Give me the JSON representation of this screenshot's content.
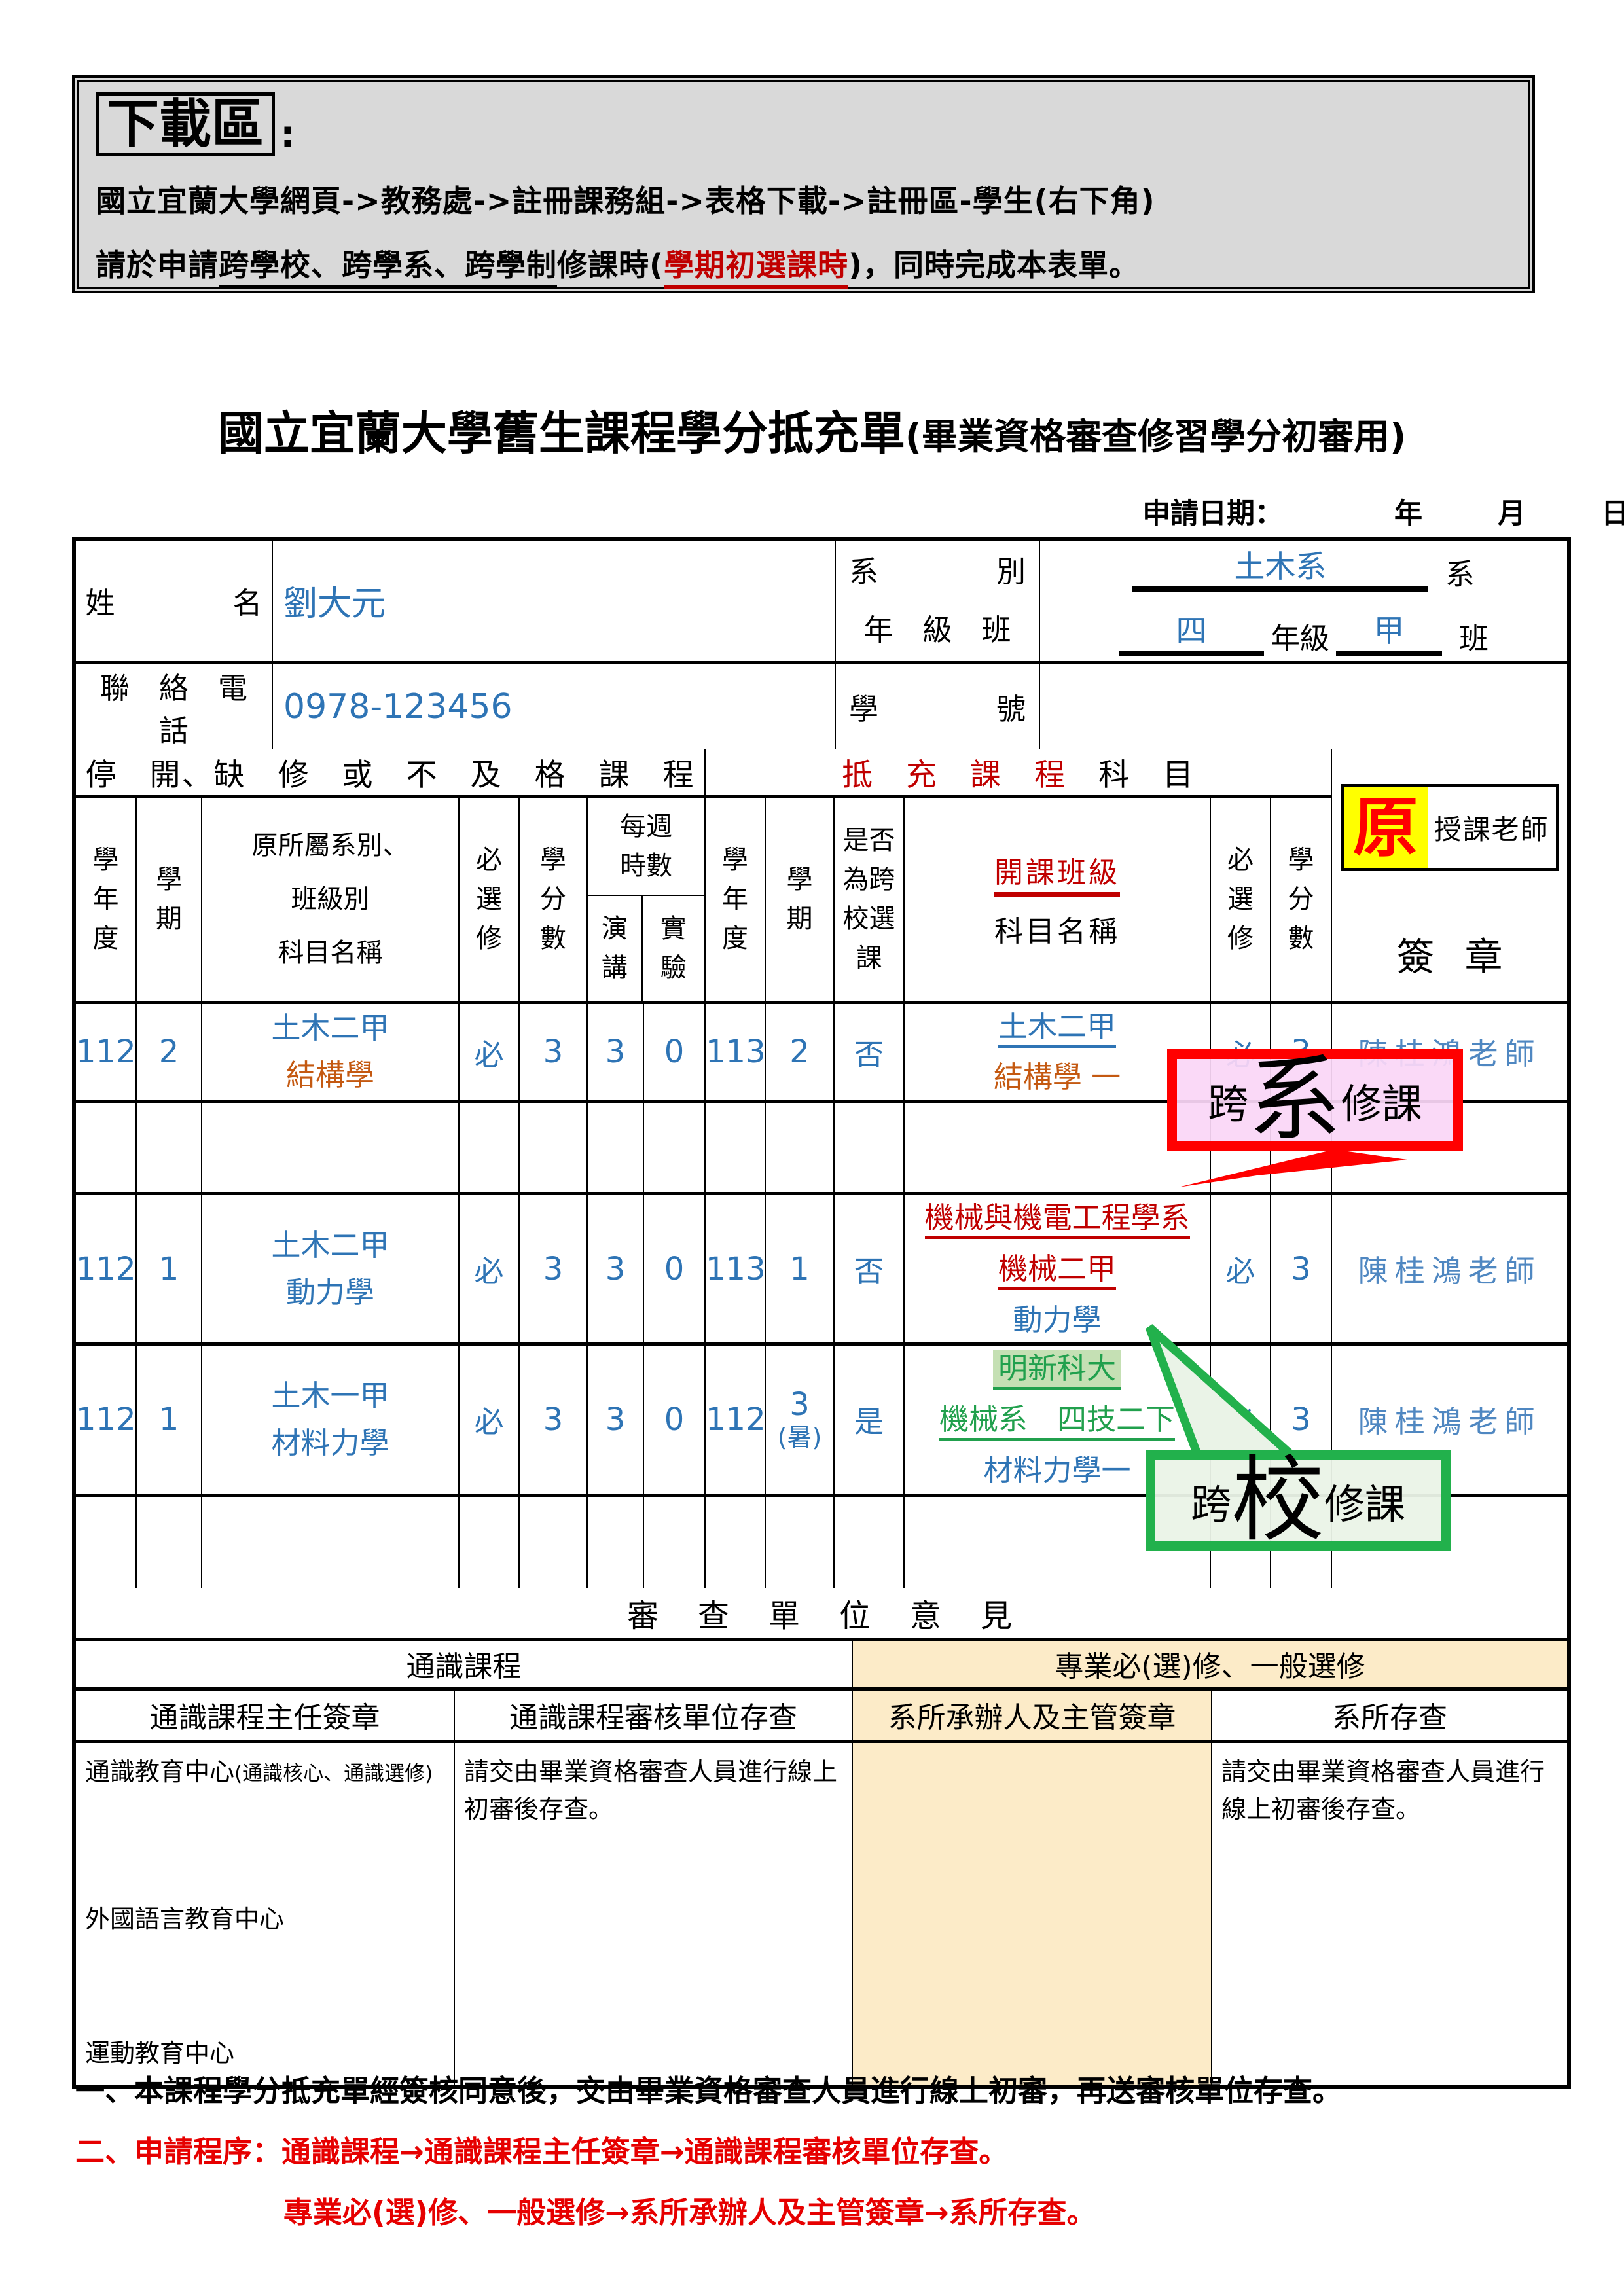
{
  "download_box": {
    "title": "下載區",
    "colon": ":",
    "path_line": "國立宜蘭大學網頁->教務處->註冊課務組->表格下載->註冊區-學生(右下角)",
    "notice_prefix": "請於申請",
    "notice_underline": "跨學校、跨學系、跨學制",
    "notice_mid": "修課時(",
    "notice_red": "學期初選課時",
    "notice_suffix": ")，同時完成本表單。"
  },
  "title": {
    "main": "國立宜蘭大學舊生課程學分抵充單",
    "paren": "(畢業資格審查修習學分初審用)"
  },
  "apply_date": {
    "label": "申請日期：",
    "year": "年",
    "month": "月",
    "day": "日"
  },
  "student": {
    "name_label": "姓　　　　名",
    "name_value": "劉大元",
    "dept_label1": "系　　　　別",
    "dept_label2": "年　級　班",
    "dept_value": "土木系",
    "dept_suffix": "系",
    "grade_value": "四",
    "grade_label": "年級",
    "class_value": "甲",
    "class_suffix": "班",
    "phone_label": "聯　絡　電　話",
    "phone_value": "0978-123456",
    "sid_label": "學　　　　號",
    "sid_value": ""
  },
  "course_table": {
    "left_section": "停　開、缺　修　或　不　及　格　課　程",
    "right_section_red": "抵　充　課　程",
    "right_section_black": "科　目",
    "teacher_orig": "原",
    "teacher_label": "授課老師",
    "teacher_sign": "簽章",
    "headers": {
      "year": "學年度",
      "term": "學期",
      "orig_course": "原所屬系別、\n班級別\n科目名稱",
      "required": "必選修",
      "credits": "學分數",
      "weekly_hours": "每週時數",
      "lecture": "演講",
      "lab": "實驗",
      "cross_school": "是否為跨校選課",
      "new_class_red": "開課班級",
      "new_class_black": "科目名稱"
    },
    "rows": [
      {
        "year": "112",
        "term": "2",
        "orig_class": "土木二甲",
        "orig_course": "結構學",
        "required": "必",
        "credits": "3",
        "lecture": "3",
        "lab": "0",
        "year2": "113",
        "term2": "2",
        "cross": "否",
        "new_line1": "土木二甲",
        "new_line2": "結構學 一",
        "req2": "必",
        "credits2": "3",
        "teacher": "陳桂鴻老師"
      },
      {
        "year": "112",
        "term": "1",
        "orig_class": "土木二甲",
        "orig_course": "動力學",
        "required": "必",
        "credits": "3",
        "lecture": "3",
        "lab": "0",
        "year2": "113",
        "term2": "1",
        "cross": "否",
        "new_line1": "機械與機電工程學系",
        "new_line2": "機械二甲",
        "new_line3": "動力學",
        "req2": "必",
        "credits2": "3",
        "teacher": "陳桂鴻老師"
      },
      {
        "year": "112",
        "term": "1",
        "orig_class": "土木一甲",
        "orig_course": "材料力學",
        "required": "必",
        "credits": "3",
        "lecture": "3",
        "lab": "0",
        "year2": "112",
        "term2": "3",
        "term2_note": "(暑)",
        "cross": "是",
        "new_line1": "明新科大",
        "new_line2": "機械系　四技二下",
        "new_line3": "材料力學一",
        "req2": "必",
        "credits2": "3",
        "teacher": "陳桂鴻老師"
      }
    ],
    "bubble_dept": {
      "pre": "跨",
      "big": "系",
      "post": "修課"
    },
    "bubble_school": {
      "pre": "跨",
      "big": "校",
      "post": "修課"
    }
  },
  "review": {
    "header": "審　查　單　位　意　見",
    "general_header": "通識課程",
    "professional_header": "專業必(選)修、一般選修",
    "sub_headers": [
      "通識課程主任簽章",
      "通識課程審核單位存查",
      "系所承辦人及主管簽章",
      "系所存查"
    ],
    "general_center1": "通識教育中心",
    "general_center1_note": "(通識核心、通識選修)",
    "general_center2": "外國語言教育中心",
    "general_center3": "運動教育中心",
    "general_archive_note": "請交由畢業資格審查人員進行線上初審後存查。",
    "dept_archive_note": "請交由畢業資格審查人員進行線上初審後存查。"
  },
  "notes": {
    "note1": "一、本課程學分抵充單經簽核同意後，交由畢業資格審查人員進行線上初審，再送審核單位存查。",
    "note2": "二、申請程序：通識課程→通識課程主任簽章→通識課程審核單位存查。",
    "note3": "專業必(選)修、一般選修→系所承辦人及主管簽章→系所存查。"
  },
  "colors": {
    "handwriting_blue": "#2E74B5",
    "teacher_blue": "#4F87C1",
    "orange": "#C45911",
    "dark_red": "#C00000",
    "bright_red": "#FF0000",
    "green": "#21A04D",
    "green_border": "#22B14C",
    "green_highlight": "#C5E0B4",
    "pink_fill": "#FAD6F6",
    "cream": "#FCEBC8",
    "grey_box": "#D9D9D9",
    "yellow_highlight": "#FFFF00"
  }
}
